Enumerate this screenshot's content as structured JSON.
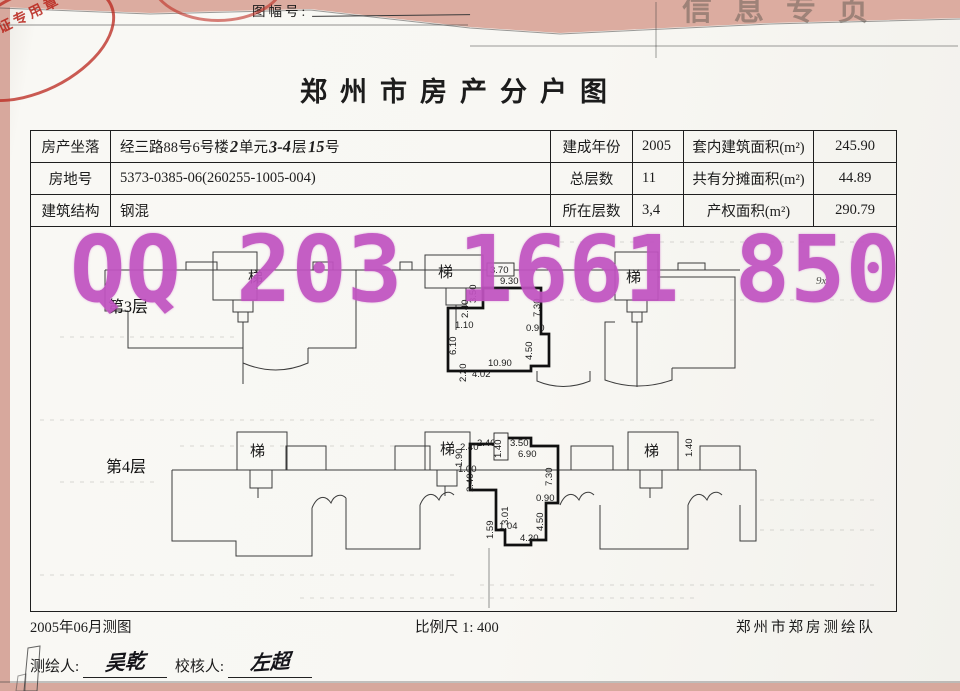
{
  "page": {
    "sheet_no_label": "图幅号:",
    "top_right_faint": "信息专页",
    "corner_stamp_text": "产权证专用章",
    "title": "郑州市房产分户图",
    "watermark": "QQ 203 1661 850",
    "accent_colors": {
      "watermark_magenta": "#c153c1",
      "stamp_red": "#b72219",
      "backing_pink": "#d7a89d"
    }
  },
  "table": {
    "rows": [
      {
        "c1": "房产坐落",
        "c2_parts": [
          "经三路88号6号楼",
          "2",
          " 单元",
          "3-4",
          "层 ",
          "15",
          " 号"
        ],
        "c3": "建成年份",
        "c4": "2005",
        "c5": "套内建筑面积(m²)",
        "c6": "245.90"
      },
      {
        "c1": "房地号",
        "c2": "5373-0385-06(260255-1005-004)",
        "c3": "总层数",
        "c4": "11",
        "c5": "共有分摊面积(m²)",
        "c6": "44.89"
      },
      {
        "c1": "建筑结构",
        "c2": "钢混",
        "c3": "所在层数",
        "c4": "3,4",
        "c5": "产权面积(m²)",
        "c6": "290.79"
      }
    ]
  },
  "plan": {
    "stair_char": "梯",
    "stray_mark": {
      "t": "9x",
      "x": 816,
      "y": 284
    },
    "floor3": {
      "label": {
        "t": "第3层",
        "x": 108,
        "y": 312
      },
      "stairs": [
        {
          "x": 248,
          "y": 282
        },
        {
          "x": 438,
          "y": 277
        },
        {
          "x": 626,
          "y": 282
        }
      ],
      "dims": [
        {
          "t": "3.70",
          "x": 490,
          "y": 273,
          "boxed": true
        },
        {
          "t": "9.30",
          "x": 500,
          "y": 284
        },
        {
          "t": "3.50",
          "x": 476,
          "y": 303,
          "vert": true
        },
        {
          "t": "2.40",
          "x": 468,
          "y": 318,
          "vert": true
        },
        {
          "t": "1.10",
          "x": 455,
          "y": 328
        },
        {
          "t": "6.10",
          "x": 456,
          "y": 355,
          "vert": true
        },
        {
          "t": "2.20",
          "x": 466,
          "y": 382,
          "vert": true
        },
        {
          "t": "4.02",
          "x": 472,
          "y": 377
        },
        {
          "t": "10.90",
          "x": 488,
          "y": 366
        },
        {
          "t": "7.30",
          "x": 540,
          "y": 317,
          "vert": true
        },
        {
          "t": "0.90",
          "x": 526,
          "y": 331
        },
        {
          "t": "4.50",
          "x": 532,
          "y": 360,
          "vert": true
        }
      ]
    },
    "floor4": {
      "label": {
        "t": "第4层",
        "x": 106,
        "y": 472
      },
      "stairs": [
        {
          "x": 250,
          "y": 456
        },
        {
          "x": 440,
          "y": 454
        },
        {
          "x": 644,
          "y": 456
        }
      ],
      "dims": [
        {
          "t": "2.40",
          "x": 477,
          "y": 446
        },
        {
          "t": "1.40",
          "x": 501,
          "y": 458,
          "vert": true,
          "boxed": true
        },
        {
          "t": "3.50",
          "x": 510,
          "y": 446
        },
        {
          "t": "6.90",
          "x": 518,
          "y": 457
        },
        {
          "t": "1.40",
          "x": 692,
          "y": 457,
          "vert": true
        },
        {
          "t": "2.40",
          "x": 460,
          "y": 450
        },
        {
          "t": "1.90",
          "x": 462,
          "y": 467,
          "vert": true
        },
        {
          "t": "1.00",
          "x": 458,
          "y": 472
        },
        {
          "t": "2.40",
          "x": 473,
          "y": 492,
          "vert": true
        },
        {
          "t": "7.30",
          "x": 552,
          "y": 486,
          "vert": true
        },
        {
          "t": "0.90",
          "x": 536,
          "y": 501
        },
        {
          "t": "4.50",
          "x": 543,
          "y": 531,
          "vert": true
        },
        {
          "t": "3.01",
          "x": 508,
          "y": 525,
          "vert": true
        },
        {
          "t": "1.04",
          "x": 499,
          "y": 529
        },
        {
          "t": "1.59",
          "x": 493,
          "y": 539,
          "vert": true
        },
        {
          "t": "4.20",
          "x": 520,
          "y": 541
        }
      ]
    }
  },
  "footer": {
    "survey_date": "2005年06月测图",
    "scale": "比例尺 1: 400",
    "agency": "郑州市郑房测绘队",
    "surveyor_label": "测绘人:",
    "surveyor_name": "吴乾",
    "checker_label": "校核人:",
    "checker_name": "左超"
  }
}
